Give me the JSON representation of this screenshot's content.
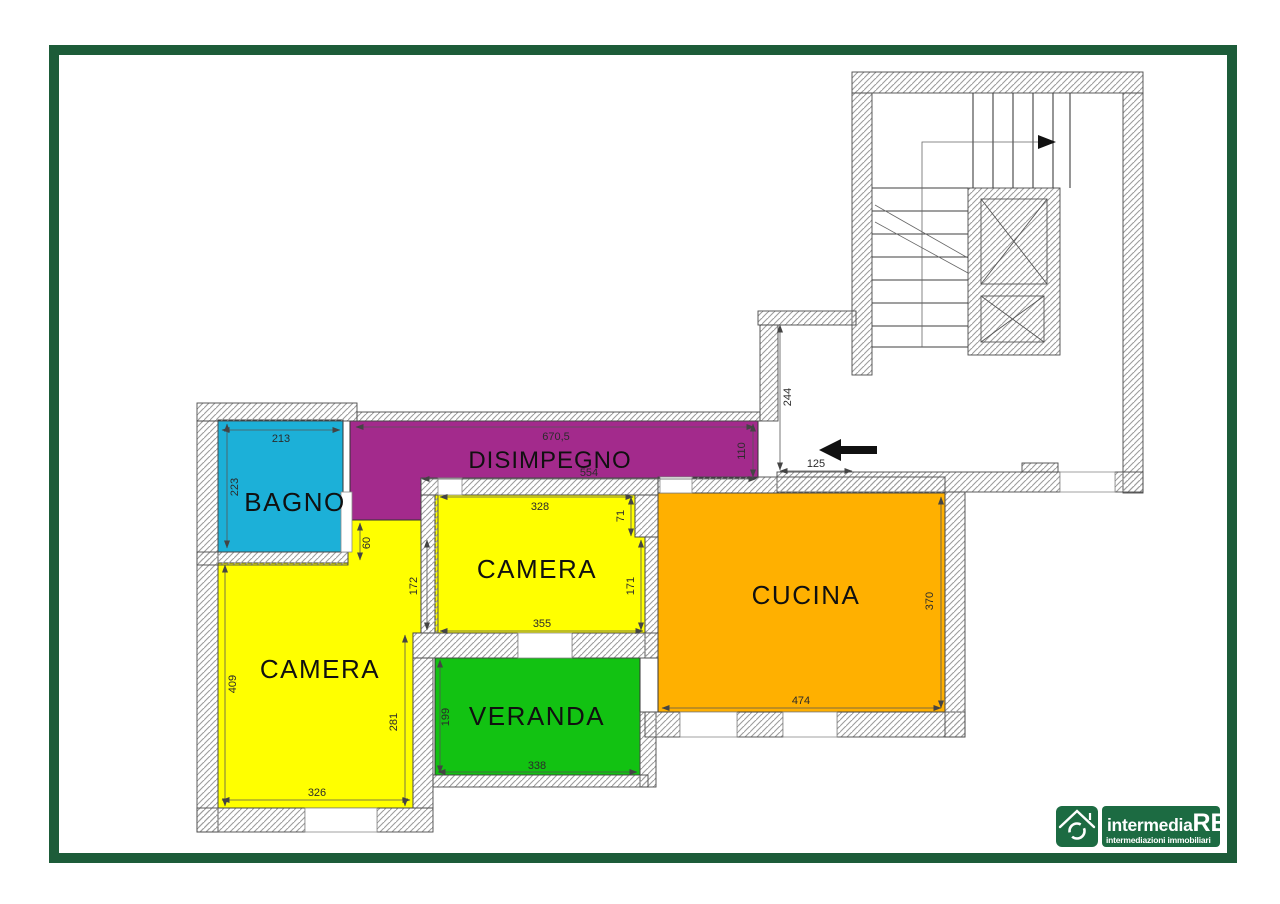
{
  "plan": {
    "rooms": {
      "bagno": {
        "label": "BAGNO"
      },
      "disimpegno": {
        "label": "DISIMPEGNO"
      },
      "camera1": {
        "label": "CAMERA"
      },
      "cucina": {
        "label": "CUCINA"
      },
      "camera2": {
        "label": "CAMERA"
      },
      "veranda": {
        "label": "VERANDA"
      }
    },
    "dimensions": {
      "bagno_top": "213",
      "bagno_left": "223",
      "disimpegno_top": "670,5",
      "disimpegno_bottom": "554",
      "disimpegno_right": "110",
      "camera1_top": "328",
      "camera1_right_upper": "71",
      "camera1_right": "171",
      "camera1_bottom": "355",
      "camera1_left": "172",
      "camera1_door": "60",
      "cucina_bottom": "474",
      "cucina_right": "370",
      "camera2_left": "409",
      "camera2_right": "281",
      "camera2_bottom": "326",
      "veranda_left": "199",
      "veranda_bottom": "338",
      "entry_height": "244",
      "entry_width": "125"
    }
  },
  "colors": {
    "bagno": "#1cb0d8",
    "disimpegno": "#a32a8c",
    "camera": "#ffff00",
    "cucina": "#ffb000",
    "veranda": "#12c212",
    "frame": "#1d5c39",
    "logo_green": "#1c6b42"
  },
  "logo": {
    "brand_prefix": "intermedia",
    "brand_suffix": "RE",
    "tagline": "intermediazioni immobiliari"
  }
}
